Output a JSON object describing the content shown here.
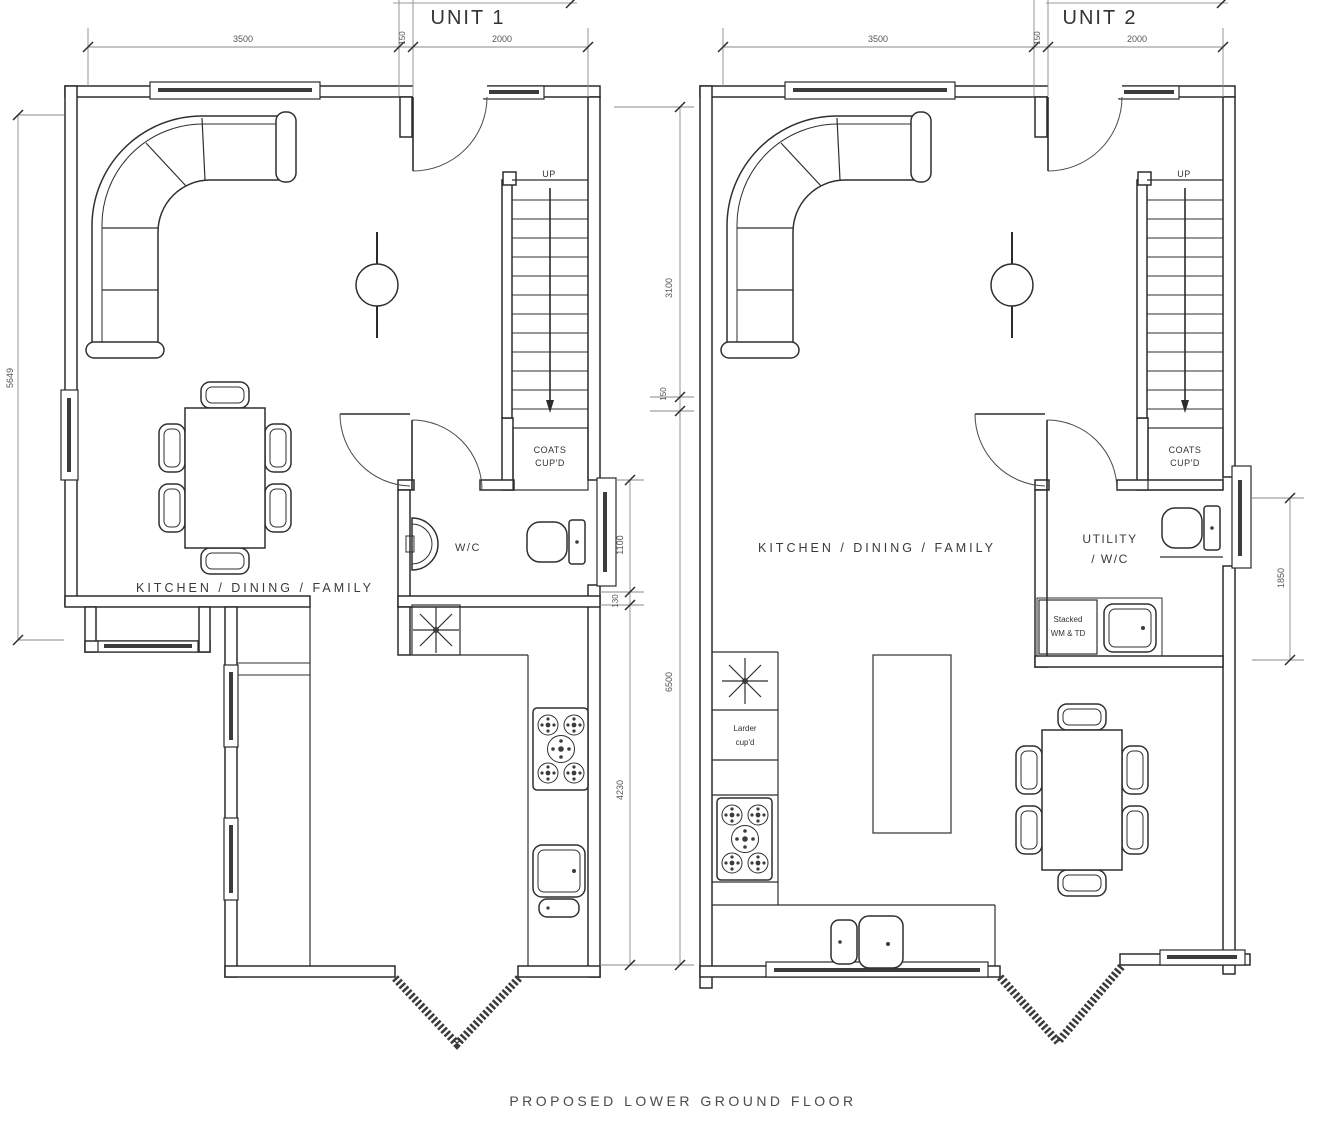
{
  "title": "PROPOSED LOWER GROUND FLOOR",
  "unit1": {
    "name": "UNIT 1",
    "room": "KITCHEN / DINING / FAMILY",
    "up": "UP",
    "coats_line1": "COATS",
    "coats_line2": "CUP'D",
    "wc": "W/C",
    "dim_top_left": "3500",
    "dim_top_mid": "150",
    "dim_top_right": "2000",
    "dim_left": "5649"
  },
  "unit2": {
    "name": "UNIT 2",
    "room": "KITCHEN / DINING / FAMILY",
    "up": "UP",
    "coats_line1": "COATS",
    "coats_line2": "CUP'D",
    "utility_line1": "UTILITY",
    "utility_line2": "/ W/C",
    "stacked_line1": "Stacked",
    "stacked_line2": "WM & TD",
    "larder_line1": "Larder",
    "larder_line2": "cup'd",
    "dim_top_left": "3500",
    "dim_top_mid": "150",
    "dim_top_right": "2000",
    "dim_right": "1850"
  },
  "middle_dims": {
    "a": "3100",
    "b": "150",
    "c": "6500",
    "d": "1100",
    "e": "130",
    "f": "4230"
  },
  "colors": {
    "wall": "#2b2b2b",
    "fixture": "#2f2f2f",
    "dim_line": "#8a8a8a",
    "dim_text": "#555555",
    "label_text": "#3a3a3a",
    "background": "#ffffff"
  }
}
